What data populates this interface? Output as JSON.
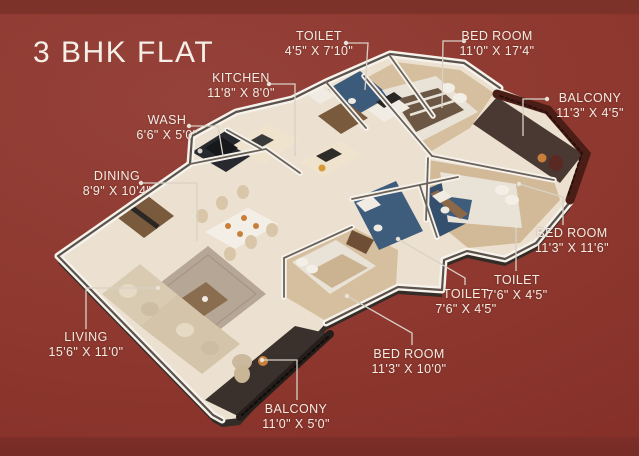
{
  "title": "3 BHK FLAT",
  "poster": {
    "type": "3d-isometric-floor-plan",
    "background_color": "#8e382f",
    "text_color": "#f2ece3",
    "leader_line_color": "#d8d1c6",
    "wall_color": "#f6f2ec",
    "bedroom_floor_color": "#d6bf9e",
    "toilet_accent_color": "#3e5c7c",
    "balcony_railing_color": "#4a1d17"
  },
  "rooms": [
    {
      "id": "toilet_top",
      "name": "TOILET",
      "size": "4'5\" X 7'10\""
    },
    {
      "id": "bedroom_1",
      "name": "BED ROOM",
      "size": "11'0\" X 17'4\""
    },
    {
      "id": "balcony_1",
      "name": "BALCONY",
      "size": "11'3\" X 4'5\""
    },
    {
      "id": "kitchen",
      "name": "KITCHEN",
      "size": "11'8\" X 8'0\""
    },
    {
      "id": "wash",
      "name": "WASH",
      "size": "6'6\" X 5'0\""
    },
    {
      "id": "dining",
      "name": "DINING",
      "size": "8'9\" X 10'4\""
    },
    {
      "id": "living",
      "name": "LIVING",
      "size": "15'6\" X 11'0\""
    },
    {
      "id": "bedroom_3",
      "name": "BED ROOM",
      "size": "11'3\" X 10'0\""
    },
    {
      "id": "balcony_2",
      "name": "BALCONY",
      "size": "11'0\" X 5'0\""
    },
    {
      "id": "toilet_left",
      "name": "TOILET",
      "size": "7'6\" X 4'5\""
    },
    {
      "id": "toilet_right",
      "name": "TOILET",
      "size": "7'6\" X 4'5\""
    },
    {
      "id": "bedroom_2",
      "name": "BED ROOM",
      "size": "11'3\" X 11'6\""
    }
  ]
}
